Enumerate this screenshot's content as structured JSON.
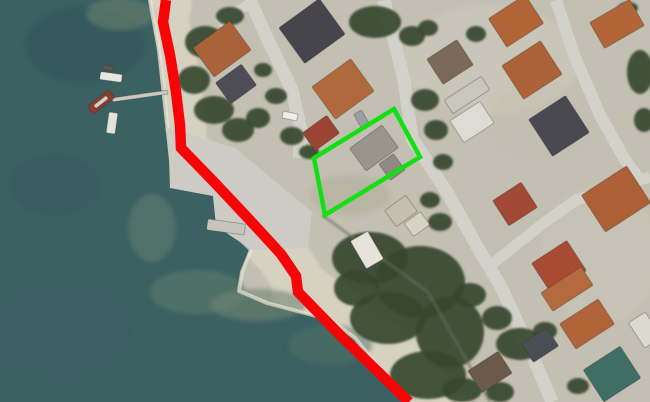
{
  "map": {
    "canvas": {
      "width": 650,
      "height": 402
    },
    "land": {
      "base_color": "#c3bfb2",
      "patches": [
        {
          "cx": 490,
          "cy": 60,
          "rx": 90,
          "ry": 55,
          "color": "#cfccc0",
          "op": 0.5
        },
        {
          "cx": 600,
          "cy": 255,
          "rx": 60,
          "ry": 70,
          "color": "#c9c5b8",
          "op": 0.5
        },
        {
          "cx": 350,
          "cy": 195,
          "rx": 40,
          "ry": 20,
          "color": "#b3af9c",
          "op": 0.6
        },
        {
          "cx": 540,
          "cy": 120,
          "rx": 50,
          "ry": 40,
          "color": "#c3bfb0",
          "op": 0.4
        },
        {
          "cx": 385,
          "cy": 345,
          "rx": 45,
          "ry": 35,
          "color": "#b7b3a0",
          "op": 0.5
        }
      ]
    },
    "sand": {
      "color": "#d6d1c1",
      "bands": [
        {
          "points": "166,0 163,22 170,55 176,92 180,125 181,148 215,183 246,216 281,254 296,276 298,292 340,335 370,364 409,402",
          "width": 52
        },
        {
          "points": "305,285 355,322 410,365 440,402",
          "width": 46
        }
      ]
    },
    "water": {
      "color": "#3c6163",
      "outline": "0,0 150,0 158,45 164,90 168,135 174,182 177,189 220,196 224,224 250,249 241,272 238,291 266,303 332,321 356,340 407,400 407,402 0,402",
      "patches": [
        {
          "cx": 85,
          "cy": 45,
          "rx": 60,
          "ry": 38,
          "color": "#32565a",
          "op": 0.55
        },
        {
          "cx": 55,
          "cy": 185,
          "rx": 45,
          "ry": 30,
          "color": "#365a5e",
          "op": 0.5
        },
        {
          "cx": 60,
          "cy": 330,
          "rx": 70,
          "ry": 50,
          "color": "#375b5f",
          "op": 0.45
        },
        {
          "cx": 120,
          "cy": 14,
          "rx": 34,
          "ry": 16,
          "color": "#6e8370",
          "op": 0.55
        },
        {
          "cx": 152,
          "cy": 228,
          "rx": 24,
          "ry": 34,
          "color": "#5d7c6e",
          "op": 0.6
        },
        {
          "cx": 198,
          "cy": 292,
          "rx": 48,
          "ry": 22,
          "color": "#5e7d6c",
          "op": 0.55
        },
        {
          "cx": 258,
          "cy": 305,
          "rx": 48,
          "ry": 16,
          "color": "#6f8673",
          "op": 0.6
        },
        {
          "cx": 330,
          "cy": 345,
          "rx": 42,
          "ry": 20,
          "color": "#527266",
          "op": 0.5
        }
      ],
      "shore_foam": [
        {
          "points": "150,0 159,50 165,105 171,160 176,186",
          "width": 4,
          "color": "#e9e4d3",
          "op": 0.8
        },
        {
          "points": "221,196 225,224 251,250 242,272 239,291 267,303 331,320 355,338 404,398",
          "width": 4,
          "color": "#e7e2d1",
          "op": 0.7
        }
      ]
    },
    "quay": {
      "color": "#ccccc5",
      "points": "168,128 235,148 312,212 308,248 252,250 216,226 213,196 170,188"
    },
    "roads": {
      "color": "#d2d1ca",
      "segments": [
        {
          "points": "250,0 268,40 292,90 301,130 299,158",
          "width": 13
        },
        {
          "points": "218,24 252,2",
          "width": 10
        },
        {
          "points": "384,0 404,80 412,138 448,194 478,248 500,285 528,345 552,402",
          "width": 13
        },
        {
          "points": "556,0 574,55 600,115 625,160 640,180",
          "width": 12
        },
        {
          "points": "487,268 545,222 576,200 650,177",
          "width": 11
        }
      ]
    },
    "vegetation": {
      "color": "#36482f",
      "blobs": [
        {
          "cx": 205,
          "cy": 42,
          "rx": 20,
          "ry": 16
        },
        {
          "cx": 194,
          "cy": 80,
          "rx": 16,
          "ry": 14
        },
        {
          "cx": 214,
          "cy": 110,
          "rx": 20,
          "ry": 14
        },
        {
          "cx": 238,
          "cy": 130,
          "rx": 16,
          "ry": 12
        },
        {
          "cx": 258,
          "cy": 118,
          "rx": 12,
          "ry": 10
        },
        {
          "cx": 230,
          "cy": 16,
          "rx": 14,
          "ry": 9
        },
        {
          "cx": 263,
          "cy": 70,
          "rx": 9,
          "ry": 7
        },
        {
          "cx": 276,
          "cy": 96,
          "rx": 11,
          "ry": 8
        },
        {
          "cx": 292,
          "cy": 136,
          "rx": 12,
          "ry": 9
        },
        {
          "cx": 309,
          "cy": 152,
          "rx": 10,
          "ry": 7
        },
        {
          "cx": 375,
          "cy": 22,
          "rx": 26,
          "ry": 16
        },
        {
          "cx": 412,
          "cy": 36,
          "rx": 13,
          "ry": 10
        },
        {
          "cx": 428,
          "cy": 28,
          "rx": 10,
          "ry": 8
        },
        {
          "cx": 476,
          "cy": 34,
          "rx": 10,
          "ry": 8
        },
        {
          "cx": 425,
          "cy": 100,
          "rx": 14,
          "ry": 11
        },
        {
          "cx": 436,
          "cy": 130,
          "rx": 12,
          "ry": 10
        },
        {
          "cx": 443,
          "cy": 162,
          "rx": 10,
          "ry": 8
        },
        {
          "cx": 430,
          "cy": 200,
          "rx": 10,
          "ry": 8
        },
        {
          "cx": 440,
          "cy": 222,
          "rx": 12,
          "ry": 9
        },
        {
          "cx": 640,
          "cy": 72,
          "rx": 13,
          "ry": 22
        },
        {
          "cx": 644,
          "cy": 120,
          "rx": 10,
          "ry": 12
        },
        {
          "cx": 628,
          "cy": 8,
          "rx": 10,
          "ry": 6
        },
        {
          "cx": 370,
          "cy": 258,
          "rx": 38,
          "ry": 26
        },
        {
          "cx": 420,
          "cy": 282,
          "rx": 45,
          "ry": 36
        },
        {
          "cx": 388,
          "cy": 318,
          "rx": 38,
          "ry": 26
        },
        {
          "cx": 450,
          "cy": 332,
          "rx": 34,
          "ry": 36
        },
        {
          "cx": 428,
          "cy": 375,
          "rx": 38,
          "ry": 24
        },
        {
          "cx": 356,
          "cy": 288,
          "rx": 22,
          "ry": 18
        },
        {
          "cx": 470,
          "cy": 295,
          "rx": 16,
          "ry": 12
        },
        {
          "cx": 497,
          "cy": 318,
          "rx": 15,
          "ry": 12
        },
        {
          "cx": 462,
          "cy": 390,
          "rx": 20,
          "ry": 12
        },
        {
          "cx": 500,
          "cy": 392,
          "rx": 14,
          "ry": 10
        },
        {
          "cx": 520,
          "cy": 344,
          "rx": 24,
          "ry": 16
        },
        {
          "cx": 545,
          "cy": 331,
          "rx": 12,
          "ry": 9
        },
        {
          "cx": 578,
          "cy": 386,
          "rx": 11,
          "ry": 8
        }
      ],
      "wall_edge": {
        "points": "322,215 428,292 490,402",
        "width": 3,
        "color": "#6a6e5e",
        "op": 0.55
      }
    },
    "buildings": [
      {
        "name": "house-orange-a",
        "color": "#aa6238",
        "cx": 222,
        "cy": 49,
        "w": 46,
        "h": 36,
        "rot": -36
      },
      {
        "name": "house-gray-b",
        "color": "#4e4c54",
        "cx": 236,
        "cy": 84,
        "w": 32,
        "h": 26,
        "rot": -36
      },
      {
        "name": "house-dark-c",
        "color": "#46444c",
        "cx": 312,
        "cy": 31,
        "w": 50,
        "h": 44,
        "rot": -36
      },
      {
        "name": "house-orange-d",
        "color": "#b0693c",
        "cx": 343,
        "cy": 89,
        "w": 48,
        "h": 40,
        "rot": -36
      },
      {
        "name": "house-red-e",
        "color": "#9c4434",
        "cx": 321,
        "cy": 133,
        "w": 30,
        "h": 22,
        "rot": -36
      },
      {
        "name": "parcel-building",
        "color": "#9a948c",
        "cx": 374,
        "cy": 148,
        "w": 40,
        "h": 28,
        "rot": -36
      },
      {
        "name": "parcel-building-wing",
        "color": "#8f8a83",
        "cx": 392,
        "cy": 167,
        "w": 18,
        "h": 20,
        "rot": -36
      },
      {
        "name": "shed-tan-1",
        "color": "#c7bfae",
        "cx": 401,
        "cy": 211,
        "w": 26,
        "h": 20,
        "rot": -36
      },
      {
        "name": "shed-tan-2",
        "color": "#d8d2c2",
        "cx": 417,
        "cy": 224,
        "w": 20,
        "h": 16,
        "rot": -36
      },
      {
        "name": "house-orange-g",
        "color": "#b06438",
        "cx": 516,
        "cy": 21,
        "w": 44,
        "h": 34,
        "rot": -33
      },
      {
        "name": "house-orange-h",
        "color": "#ad6136",
        "cx": 532,
        "cy": 70,
        "w": 46,
        "h": 40,
        "rot": -33
      },
      {
        "name": "house-dark-i",
        "color": "#4a4850",
        "cx": 559,
        "cy": 126,
        "w": 44,
        "h": 44,
        "rot": -33
      },
      {
        "name": "house-brown-j",
        "color": "#7c6a58",
        "cx": 450,
        "cy": 62,
        "w": 36,
        "h": 30,
        "rot": -33
      },
      {
        "name": "house-light-l",
        "color": "#c9c6bd",
        "cx": 467,
        "cy": 95,
        "w": 44,
        "h": 16,
        "rot": -33
      },
      {
        "name": "house-white-m",
        "color": "#dddcd4",
        "cx": 472,
        "cy": 122,
        "w": 36,
        "h": 26,
        "rot": -33
      },
      {
        "name": "house-orange-n",
        "color": "#b26539",
        "cx": 617,
        "cy": 24,
        "w": 46,
        "h": 30,
        "rot": -30
      },
      {
        "name": "house-red-p",
        "color": "#a24936",
        "cx": 515,
        "cy": 204,
        "w": 34,
        "h": 30,
        "rot": -33
      },
      {
        "name": "house-orange-q",
        "color": "#ad6035",
        "cx": 616,
        "cy": 199,
        "w": 54,
        "h": 44,
        "rot": -33
      },
      {
        "name": "house-red-r",
        "color": "#a84c35",
        "cx": 559,
        "cy": 267,
        "w": 42,
        "h": 36,
        "rot": -33
      },
      {
        "name": "house-orange-s",
        "color": "#b26a3e",
        "cx": 567,
        "cy": 289,
        "w": 48,
        "h": 22,
        "rot": -33
      },
      {
        "name": "house-orange-t",
        "color": "#b06438",
        "cx": 587,
        "cy": 324,
        "w": 46,
        "h": 30,
        "rot": -33
      },
      {
        "name": "house-teal-u",
        "color": "#3e6e64",
        "cx": 612,
        "cy": 374,
        "w": 44,
        "h": 38,
        "rot": -33
      },
      {
        "name": "house-brown-v",
        "color": "#6b5a4a",
        "cx": 490,
        "cy": 372,
        "w": 36,
        "h": 26,
        "rot": -33
      },
      {
        "name": "white-building-shore",
        "color": "#e6e4da",
        "cx": 367,
        "cy": 250,
        "w": 20,
        "h": 32,
        "rot": -30
      },
      {
        "name": "house-dark-x",
        "color": "#474f55",
        "cx": 540,
        "cy": 345,
        "w": 30,
        "h": 22,
        "rot": -33
      },
      {
        "name": "edge-building",
        "color": "#dcd9d0",
        "cx": 645,
        "cy": 330,
        "w": 20,
        "h": 30,
        "rot": -33
      }
    ],
    "piers": [
      {
        "name": "pier-main",
        "color": "#ccc9c2",
        "cx": 140,
        "cy": 96,
        "w": 56,
        "h": 4,
        "rot": -8
      },
      {
        "name": "pier-small",
        "color": "#c6c4bc",
        "cx": 226,
        "cy": 227,
        "w": 38,
        "h": 11,
        "rot": 8
      }
    ],
    "boats": [
      {
        "name": "boat-white-1",
        "color": "#e8e6e0",
        "cx": 111,
        "cy": 77,
        "w": 22,
        "h": 8,
        "rot": 8
      },
      {
        "name": "boat-dinghy",
        "color": "#5a5a52",
        "cx": 108,
        "cy": 68,
        "w": 11,
        "h": 5,
        "rot": 8
      },
      {
        "name": "boat-red",
        "color": "#8d3c2e",
        "cx": 101,
        "cy": 102,
        "w": 27,
        "h": 10,
        "rot": -38
      },
      {
        "name": "boat-red-deck",
        "color": "#d8cfc4",
        "cx": 101,
        "cy": 102,
        "w": 16,
        "h": 4,
        "rot": -38
      },
      {
        "name": "boat-white-2",
        "color": "#e5e3dc",
        "cx": 112,
        "cy": 123,
        "w": 9,
        "h": 21,
        "rot": 8
      }
    ],
    "vehicles": [
      {
        "name": "car-white",
        "color": "#eeeeea",
        "cx": 290,
        "cy": 116,
        "w": 15,
        "h": 7,
        "rot": 12
      },
      {
        "name": "van-gray",
        "color": "#9aa0a2",
        "cx": 362,
        "cy": 120,
        "w": 9,
        "h": 18,
        "rot": -30
      }
    ],
    "overlays": {
      "coastline_boundary": {
        "color": "#f80407",
        "width": 10.5,
        "points": "166,0 163,22 170,55 176,92 180,125 181,148 215,183 246,216 281,254 296,276 298,292 340,335 370,364 409,402"
      },
      "parcel_highlight": {
        "color": "#12e012",
        "width": 4.5,
        "points": "394,109 420,157 325,215 314,158"
      }
    }
  }
}
